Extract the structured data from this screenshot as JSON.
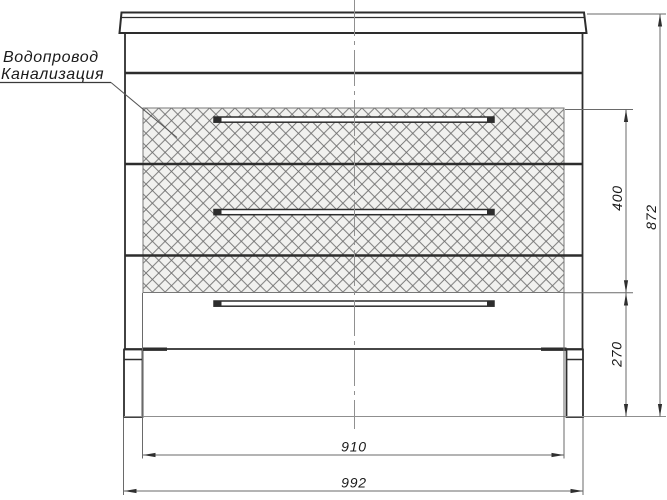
{
  "drawing": {
    "type": "furniture-front-elevation",
    "subject": "vanity-cabinet-with-three-drawers",
    "labels": {
      "line1": "Водопровод",
      "line2": "Канализация"
    },
    "dimensions": {
      "hatch_zone_height": "400",
      "overall_height": "872",
      "hatch_zone_bottom_offset": "270",
      "hatch_zone_width": "910",
      "overall_width": "992"
    },
    "colors": {
      "background": "#ffffff",
      "outline": "#2d2d2d",
      "dimension_lines": "#6a6a6a",
      "centerline": "#909090",
      "hatch_lines": "#6d6d6d",
      "hatch_fill": "#f1f1ef",
      "text": "#1a1a1a"
    }
  }
}
